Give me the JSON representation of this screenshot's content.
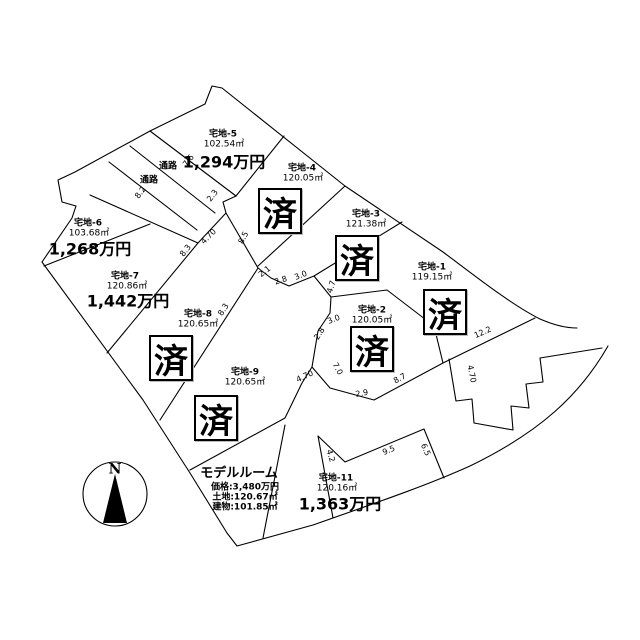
{
  "sold_mark": "済",
  "plots": [
    {
      "id": "宅地-1",
      "area": "119.15㎡",
      "status": "済"
    },
    {
      "id": "宅地-2",
      "area": "120.05㎡",
      "status": "済"
    },
    {
      "id": "宅地-3",
      "area": "121.38㎡",
      "status": "済"
    },
    {
      "id": "宅地-4",
      "area": "120.05㎡",
      "status": "済"
    },
    {
      "id": "宅地-5",
      "area": "102.54㎡",
      "price": "1,294万円"
    },
    {
      "id": "宅地-6",
      "area": "103.68㎡",
      "price": "1,268万円"
    },
    {
      "id": "宅地-7",
      "area": "120.86㎡",
      "price": "1,442万円"
    },
    {
      "id": "宅地-8",
      "area": "120.65㎡",
      "status": "済"
    },
    {
      "id": "宅地-9",
      "area": "120.65㎡",
      "status": "済"
    },
    {
      "id": "宅地-11",
      "area": "120.16㎡",
      "price": "1,363万円"
    }
  ],
  "model_room": {
    "title": "モデルルーム",
    "price": "価格:3,480万円",
    "land": "土地:120.67㎡",
    "building": "建物:101.85㎡"
  },
  "passages": [
    {
      "label": "通路"
    },
    {
      "label": "通路"
    }
  ],
  "compass": {
    "label": "N"
  },
  "dimensions": [
    {
      "text": "7.6"
    },
    {
      "text": "8.2"
    },
    {
      "text": "2.3"
    },
    {
      "text": "4.70"
    },
    {
      "text": "8.5"
    },
    {
      "text": "8.3"
    },
    {
      "text": "2.1"
    },
    {
      "text": "2.8"
    },
    {
      "text": "3.0"
    },
    {
      "text": "4.7"
    },
    {
      "text": "3.0"
    },
    {
      "text": "2.8"
    },
    {
      "text": "7.0"
    },
    {
      "text": "4.70"
    },
    {
      "text": "2.9"
    },
    {
      "text": "8.7"
    },
    {
      "text": "12.2"
    },
    {
      "text": "4.70"
    },
    {
      "text": "4.2"
    },
    {
      "text": "9.5"
    },
    {
      "text": "6.5"
    },
    {
      "text": "8.3"
    }
  ]
}
